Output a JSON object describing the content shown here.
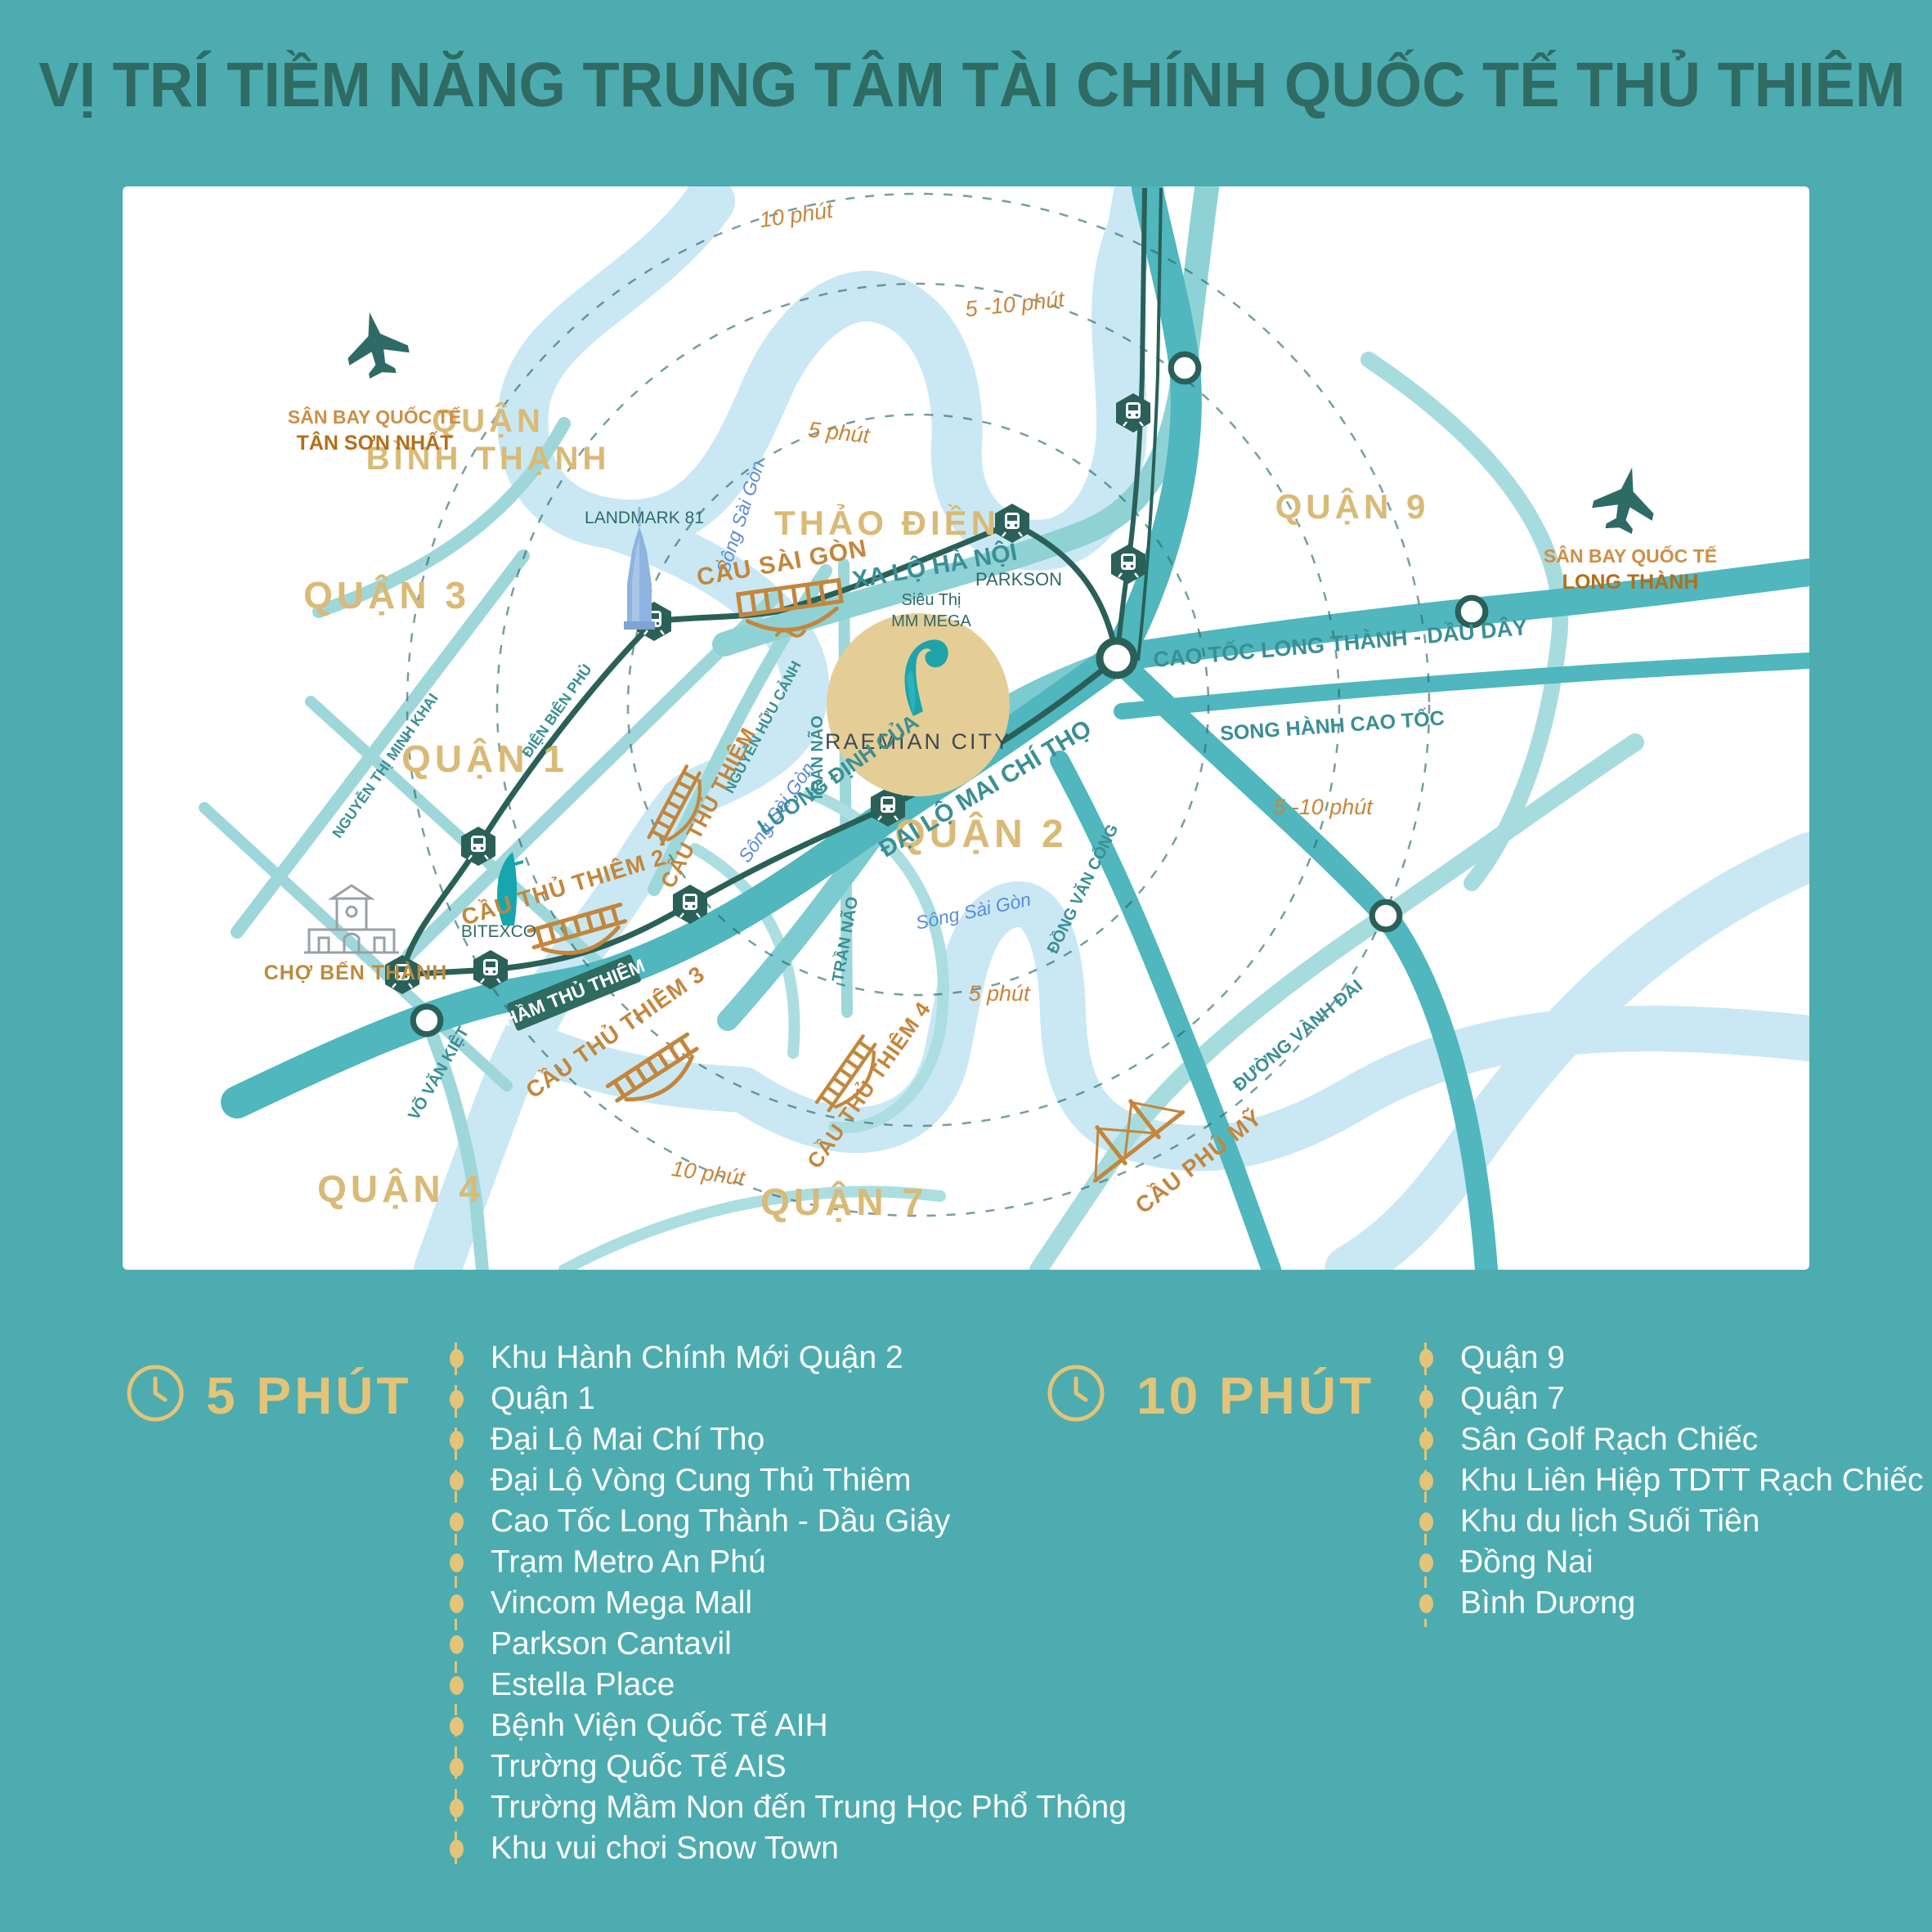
{
  "title": "VỊ TRÍ TIỀM NĂNG TRUNG TÂM TÀI CHÍNH QUỐC TẾ THỦ THIÊM",
  "colors": {
    "background": "#4DACB0",
    "panel": "#FFFFFF",
    "gold_accent": "#E3C478",
    "district_gold": "#D9BA76",
    "bridge_gold": "#C3863C",
    "road_teal": "#4FB7BD",
    "light_road_teal": "#9ED7DA",
    "river_blue": "#C9E8F4",
    "metro_dark": "#2A6058",
    "road_label_teal": "#3A8F94",
    "river_label_blue": "#5C8BD9",
    "airport_orange": "#B26E1C",
    "title_teal": "#2F6B63",
    "raemian_circle": "#E5CD96"
  },
  "map": {
    "districts": {
      "binh_thanh_1": "QUẬN",
      "binh_thanh_2": "BÌNH THẠNH",
      "q3": "QUẬN 3",
      "q1": "QUẬN 1",
      "q2": "QUẬN 2",
      "q4": "QUẬN 4",
      "q7": "QUẬN 7",
      "q9": "QUẬN 9",
      "thao_dien": "THẢO ĐIỀN"
    },
    "rings": {
      "five": "5 phút",
      "five_ten": "5 -10 phút",
      "ten": "10 phút"
    },
    "river": "Sông Sài Gòn",
    "roads": {
      "xa_lo_ha_noi": "XA LỘ HÀ NỘI",
      "cao_toc": "CAO TỐC LONG THÀNH - DẦU DÂY",
      "song_hanh": "SONG HÀNH CAO TỐC",
      "mai_chi_tho": "ĐẠI LỘ MAI CHÍ THỌ",
      "luong_dinh_cua": "LƯƠNG ĐỊNH CỦA",
      "tran_nao": "TRẦN NÃO",
      "dong_van_cong": "ĐỒNG VĂN CỔNG",
      "vanh_dai": "ĐƯỜNG VÀNH ĐAI",
      "vo_van_kiet": "VÕ VĂN KIỆT",
      "ntmk": "NGUYỄN THỊ MINH KHAI",
      "dbp": "ĐIỆN BIÊN PHỦ",
      "nhc": "NGUYỄN HỮU CẢNH",
      "ham": "HẦM THỦ THIÊM"
    },
    "bridges": {
      "sai_gon": "CẦU SÀI GÒN",
      "tt": "CẦU THỦ THIÊM",
      "tt2": "CẦU THỦ THIÊM 2",
      "tt3": "CẦU THỦ THIÊM 3",
      "tt4": "CẦU THỦ THIÊM 4",
      "phu_my": "CẦU PHÚ MỸ"
    },
    "landmarks": {
      "landmark81": "LANDMARK 81",
      "bitexco": "BITEXCO",
      "ben_thanh": "CHỢ BẾN THÀNH",
      "parkson": "PARKSON",
      "sieu_thi": "Siêu Thị",
      "mm_mega": "MM MEGA",
      "raemian": "RAEMIAN CITY"
    },
    "airports": {
      "intl": "SÂN BAY QUỐC TẾ",
      "tsn": "TÂN SƠN NHẤT",
      "lt": "LONG THÀNH"
    }
  },
  "lists": {
    "five": {
      "header": "5 PHÚT",
      "items": [
        "Khu Hành Chính Mới Quận 2",
        "Quận 1",
        "Đại Lộ Mai Chí Thọ",
        "Đại Lộ Vòng Cung Thủ Thiêm",
        "Cao Tốc Long Thành - Dầu Giây",
        "Trạm Metro An Phú",
        "Vincom Mega Mall",
        "Parkson Cantavil",
        "Estella Place",
        "Bệnh Viện Quốc Tế AIH",
        "Trường Quốc Tế AIS",
        "Trường Mầm Non đến Trung Học Phổ Thông",
        "Khu vui chơi Snow Town"
      ]
    },
    "ten": {
      "header": "10 PHÚT",
      "items": [
        "Quận 9",
        "Quận 7",
        "Sân Golf Rạch Chiếc",
        "Khu Liên Hiệp TDTT Rạch Chiếc",
        "Khu du lịch Suối Tiên",
        "Đồng Nai",
        "Bình Dương"
      ]
    }
  }
}
